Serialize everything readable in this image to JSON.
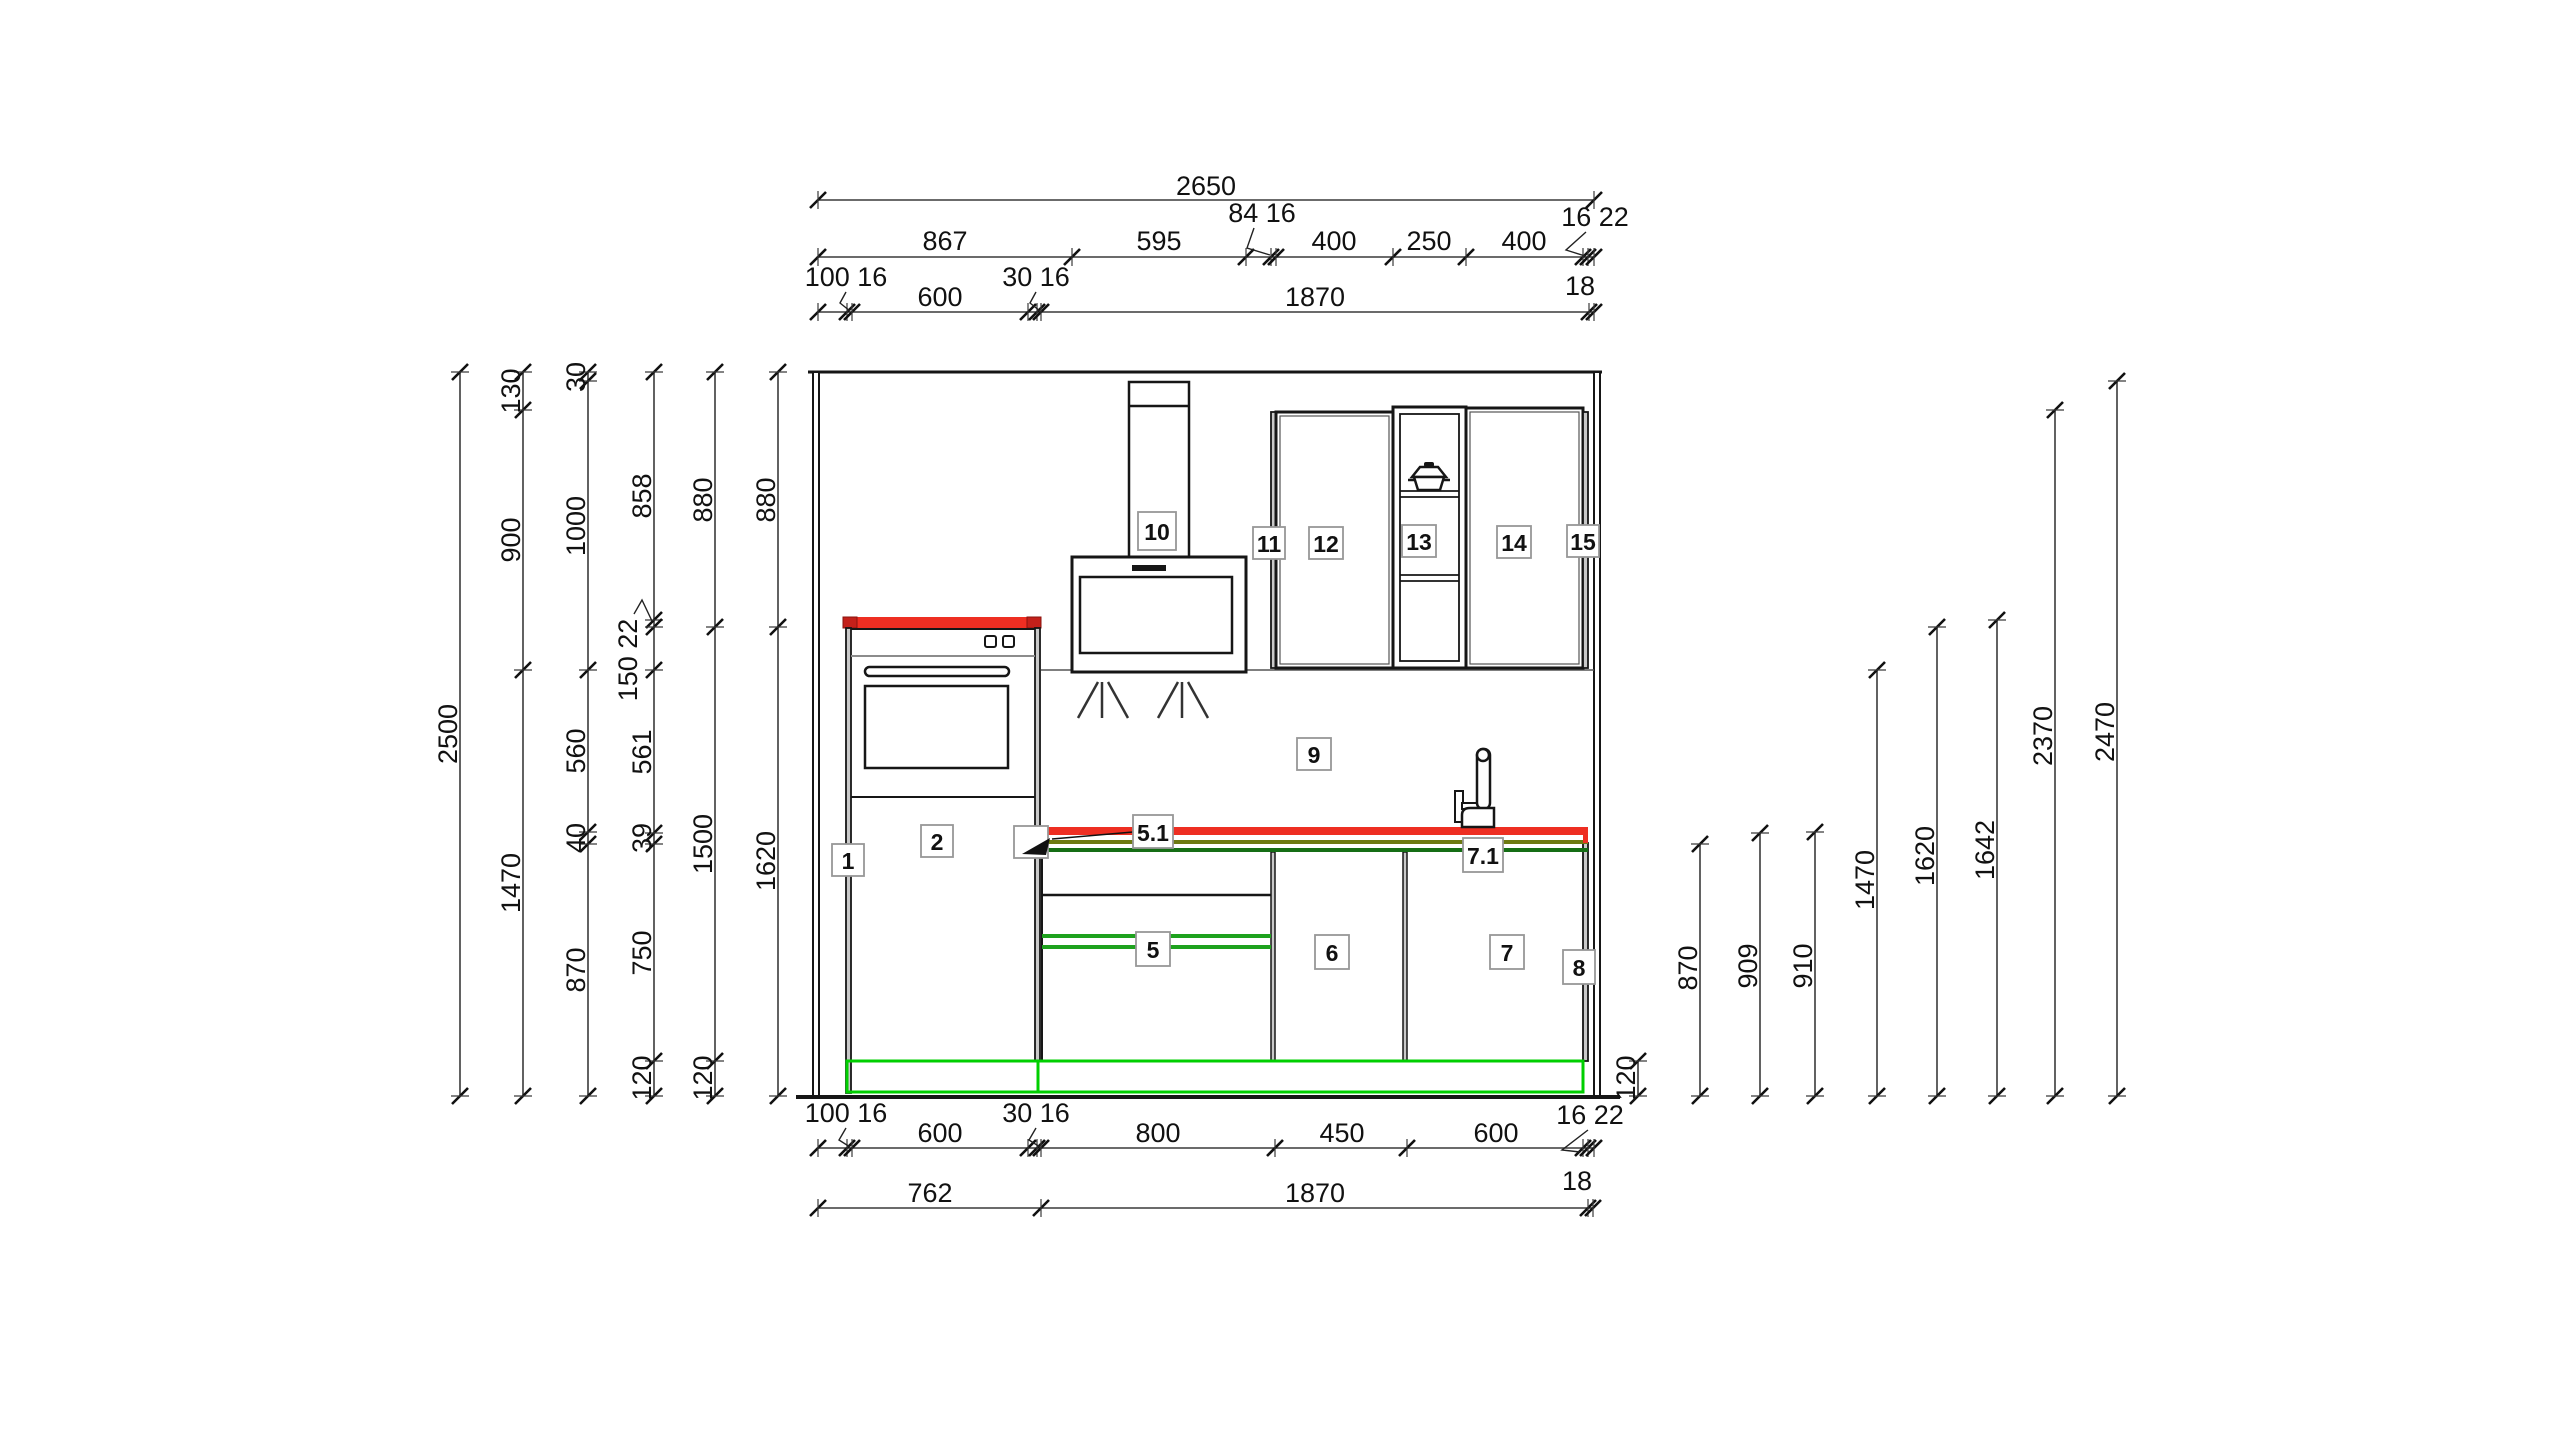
{
  "title": "kitchen-elevation-cad-drawing",
  "colors": {
    "worktop_red": "#ee2e22",
    "worktop_red_dark": "#c3201a",
    "edge_olive": "#6d7a12",
    "edge_dark_green": "#156d15",
    "highlight_green": "#1ea21e",
    "plinth_green": "#00cf00",
    "line_black": "#161616",
    "dim_gray": "#333333"
  },
  "item_labels": {
    "n1": "1",
    "n2": "2",
    "n5": "5",
    "n5_1": "5.1",
    "n6": "6",
    "n7": "7",
    "n7_1": "7.1",
    "n8": "8",
    "n9": "9",
    "n10": "10",
    "n11": "11",
    "n12": "12",
    "n13": "13",
    "n14": "14",
    "n15": "15"
  },
  "dims": {
    "top_total": "2650",
    "top_row2": [
      "867",
      "595",
      "400",
      "250",
      "400"
    ],
    "top_row2_callouts": [
      "84 16",
      "16 22"
    ],
    "top_row3": [
      "600",
      "1870"
    ],
    "top_row3_callouts": [
      "100 16",
      "30 16"
    ],
    "top_row3_end": "18",
    "bottom_row1": [
      "600",
      "800",
      "450",
      "600"
    ],
    "bottom_row1_callouts": [
      "100 16",
      "30 16",
      "16 22"
    ],
    "bottom_row1_end": "18",
    "bottom_row2": [
      "762",
      "1870"
    ],
    "left_total": "2500",
    "left_chain2": [
      "130",
      "900",
      "1470"
    ],
    "left_chain3": [
      "30",
      "1000",
      "560",
      "40",
      "870"
    ],
    "left_chain4": [
      "858",
      "150 22",
      "561",
      "39",
      "750",
      "120"
    ],
    "left_chain5": [
      "880",
      "1500",
      "120"
    ],
    "left_chain6": [
      "880",
      "1620"
    ],
    "right_plinth": "120",
    "right_heights": [
      "870",
      "909",
      "910",
      "1470",
      "1620",
      "1642",
      "2370",
      "2470"
    ]
  }
}
